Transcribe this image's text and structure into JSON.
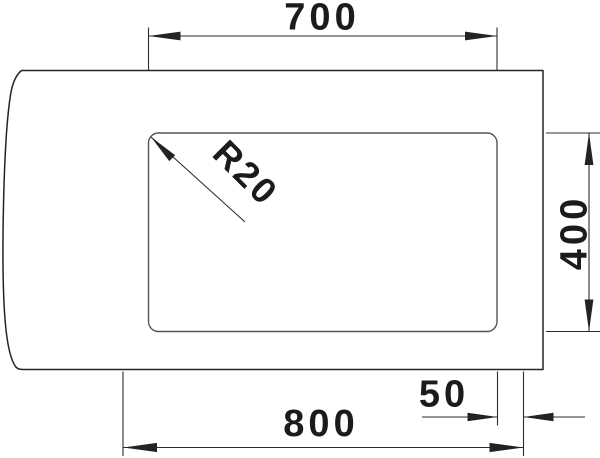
{
  "labels": {
    "cutout_width": "700",
    "cutout_height": "400",
    "overall_width": "800",
    "edge_offset": "50",
    "corner_radius": "R20"
  },
  "colors": {
    "background": "#ffffff",
    "outline": "#232323",
    "cutout_outline": "#555555",
    "text": "#1b1b1b"
  }
}
